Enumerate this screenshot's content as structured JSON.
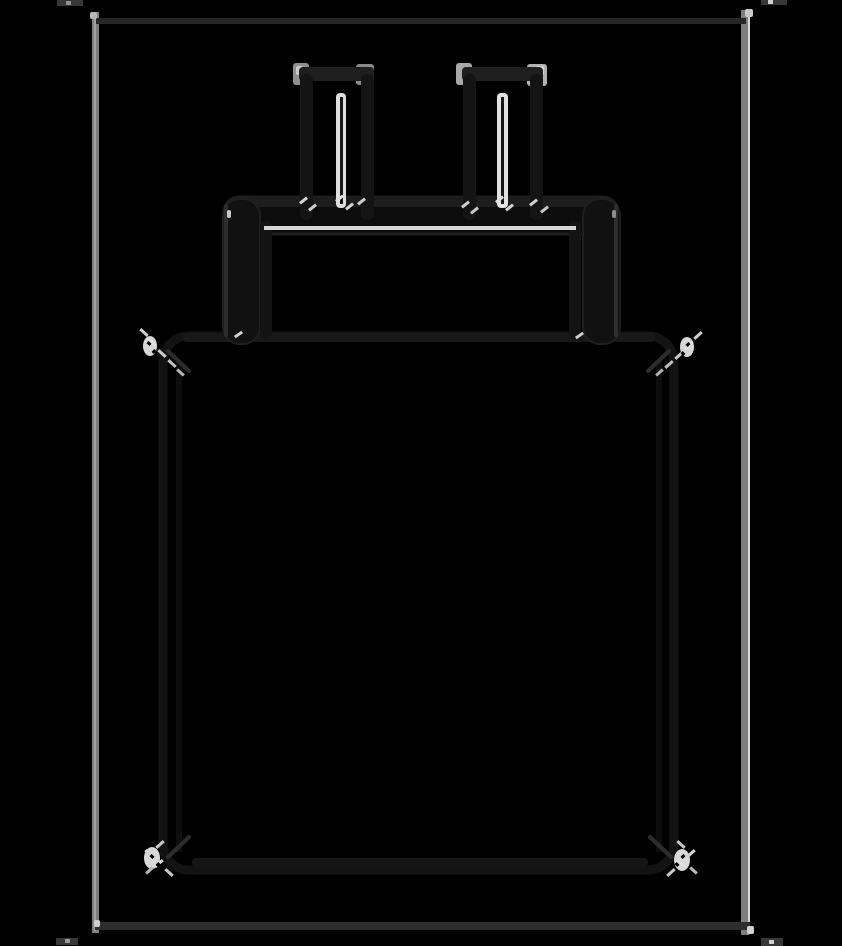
{
  "canvas": {
    "width": 842,
    "height": 946,
    "background": "#000000"
  },
  "figure": {
    "subject": "wall-charger-plug-sketch",
    "style": "inverted pencil sketch: gray and white strokes on black"
  },
  "palette": {
    "background": "#000000",
    "frame_side_gray": "#7e7e7e",
    "frame_horizontal_dark": "#2a2a2a",
    "stroke_dark": "#141414",
    "stroke_medium": "#1f1f1f",
    "highlight_white": "#dedede",
    "corner_gray": "#8f8f8f"
  },
  "drawing": {
    "shapes": [
      {
        "n": "frame-left-edge",
        "t": "rect",
        "x": 92,
        "y": 12,
        "w": 7,
        "h": 921,
        "f": "#7e7e7e"
      },
      {
        "n": "frame-left-core",
        "t": "rect",
        "x": 94,
        "y": 14,
        "w": 2,
        "h": 917,
        "f": "#a2a2a2"
      },
      {
        "n": "frame-right-edge",
        "t": "rect",
        "x": 741,
        "y": 10,
        "w": 8,
        "h": 925,
        "f": "#7e7e7e"
      },
      {
        "n": "frame-right-core",
        "t": "rect",
        "x": 748,
        "y": 12,
        "w": 2,
        "h": 921,
        "f": "#d8d8d8"
      },
      {
        "n": "frame-top-edge",
        "t": "rect",
        "x": 96,
        "y": 18,
        "w": 650,
        "h": 6,
        "f": "#272727"
      },
      {
        "n": "frame-bottom-edge",
        "t": "rect",
        "x": 95,
        "y": 922,
        "w": 655,
        "h": 8,
        "f": "#2d2d2d"
      },
      {
        "n": "frame-corner-dot-tl",
        "t": "rect",
        "x": 90,
        "y": 12,
        "w": 7,
        "h": 7,
        "rx": 2,
        "f": "#b8b8b8"
      },
      {
        "n": "frame-corner-dot-tr",
        "t": "rect",
        "x": 745,
        "y": 9,
        "w": 8,
        "h": 8,
        "rx": 2,
        "f": "#c9c9c9"
      },
      {
        "n": "frame-corner-dot-bl",
        "t": "rect",
        "x": 94,
        "y": 920,
        "w": 6,
        "h": 7,
        "rx": 2,
        "f": "#cfcfcf"
      },
      {
        "n": "frame-corner-dot-br",
        "t": "rect",
        "x": 747,
        "y": 926,
        "w": 7,
        "h": 8,
        "rx": 2,
        "f": "#d2d2d2"
      },
      {
        "n": "frame-tick-top-left",
        "t": "rect",
        "x": 57,
        "y": 0,
        "w": 26,
        "h": 6,
        "f": "#383838"
      },
      {
        "n": "frame-tick-top-left-dot",
        "t": "rect",
        "x": 66,
        "y": 1,
        "w": 5,
        "h": 4,
        "f": "#8e8e8e"
      },
      {
        "n": "frame-tick-top-right",
        "t": "rect",
        "x": 761,
        "y": 0,
        "w": 26,
        "h": 5,
        "f": "#383838"
      },
      {
        "n": "frame-tick-top-right-dot",
        "t": "rect",
        "x": 768,
        "y": 0,
        "w": 5,
        "h": 4,
        "f": "#cfcfcf"
      },
      {
        "n": "frame-tick-bottom-left",
        "t": "rect",
        "x": 56,
        "y": 938,
        "w": 22,
        "h": 7,
        "f": "#383838"
      },
      {
        "n": "frame-tick-bottom-left-dot",
        "t": "rect",
        "x": 65,
        "y": 939,
        "w": 5,
        "h": 4,
        "f": "#9a9a9a"
      },
      {
        "n": "frame-tick-bottom-right",
        "t": "rect",
        "x": 761,
        "y": 938,
        "w": 22,
        "h": 8,
        "f": "#383838"
      },
      {
        "n": "frame-tick-bottom-right-dot",
        "t": "rect",
        "x": 769,
        "y": 940,
        "w": 5,
        "h": 4,
        "f": "#cfcfcf"
      },
      {
        "n": "body-outline",
        "t": "rect",
        "x": 163,
        "y": 336,
        "w": 511,
        "h": 534,
        "rx": 26,
        "f": "none",
        "s": "#131313",
        "sw": 9
      },
      {
        "n": "body-left-inner-line",
        "t": "rect",
        "x": 176,
        "y": 360,
        "w": 6,
        "h": 492,
        "f": "#0e0e0e"
      },
      {
        "n": "body-right-inner-line",
        "t": "rect",
        "x": 656,
        "y": 360,
        "w": 6,
        "h": 492,
        "f": "#0e0e0e"
      },
      {
        "n": "body-top-edge-emphasis",
        "t": "rect",
        "x": 183,
        "y": 333,
        "w": 472,
        "h": 9,
        "rx": 4,
        "f": "#181818"
      },
      {
        "n": "body-bottom-edge-emphasis",
        "t": "rect",
        "x": 192,
        "y": 858,
        "w": 456,
        "h": 9,
        "rx": 4,
        "f": "#151515"
      },
      {
        "n": "body-corner-diagonal-tl",
        "t": "line",
        "x1": 168,
        "y1": 351,
        "x2": 189,
        "y2": 371,
        "s": "#2c2c2c",
        "sw": 4
      },
      {
        "n": "body-corner-diagonal-tr",
        "t": "line",
        "x1": 669,
        "y1": 351,
        "x2": 648,
        "y2": 371,
        "s": "#2c2c2c",
        "sw": 4
      },
      {
        "n": "body-corner-diagonal-bl",
        "t": "line",
        "x1": 189,
        "y1": 837,
        "x2": 168,
        "y2": 857,
        "s": "#2c2c2c",
        "sw": 4
      },
      {
        "n": "body-corner-diagonal-br",
        "t": "line",
        "x1": 650,
        "y1": 837,
        "x2": 671,
        "y2": 857,
        "s": "#2c2c2c",
        "sw": 4
      },
      {
        "n": "collar-bar",
        "t": "rect",
        "x": 224,
        "y": 197,
        "w": 394,
        "h": 37,
        "rx": 15,
        "f": "#0c0c0c",
        "s": "#1e1e1e",
        "sw": 3
      },
      {
        "n": "collar-top-emphasis",
        "t": "rect",
        "x": 240,
        "y": 197,
        "w": 362,
        "h": 10,
        "rx": 4,
        "f": "#1d1d1d"
      },
      {
        "n": "collar-left-leg",
        "t": "rect",
        "x": 223,
        "y": 199,
        "w": 37,
        "h": 145,
        "rx": 17,
        "f": "#111111",
        "s": "#1f1f1f",
        "sw": 2
      },
      {
        "n": "collar-left-leg-outer-edge",
        "t": "rect",
        "x": 224,
        "y": 204,
        "w": 4,
        "h": 133,
        "rx": 2,
        "f": "#2e2e2e"
      },
      {
        "n": "collar-left-leg-inner-line",
        "t": "rect",
        "x": 260,
        "y": 221,
        "w": 12,
        "h": 117,
        "rx": 5,
        "f": "#131313"
      },
      {
        "n": "collar-right-leg",
        "t": "rect",
        "x": 583,
        "y": 199,
        "w": 37,
        "h": 145,
        "rx": 17,
        "f": "#111111",
        "s": "#1f1f1f",
        "sw": 2
      },
      {
        "n": "collar-right-leg-outer-edge",
        "t": "rect",
        "x": 614,
        "y": 204,
        "w": 4,
        "h": 133,
        "rx": 2,
        "f": "#2e2e2e"
      },
      {
        "n": "collar-right-leg-inner-line",
        "t": "rect",
        "x": 569,
        "y": 221,
        "w": 12,
        "h": 117,
        "rx": 5,
        "f": "#131313"
      },
      {
        "n": "left-prong-top-corner-left-highlight",
        "t": "rect",
        "x": 293,
        "y": 63,
        "w": 16,
        "h": 22,
        "rx": 3,
        "f": "#8f8f8f"
      },
      {
        "n": "left-prong-top-corner-left-bright",
        "t": "rect",
        "x": 296,
        "y": 66,
        "w": 7,
        "h": 9,
        "rx": 2,
        "f": "#c9c9c9"
      },
      {
        "n": "left-prong-top-corner-right-highlight",
        "t": "rect",
        "x": 356,
        "y": 64,
        "w": 18,
        "h": 21,
        "rx": 3,
        "f": "#8a8a8a"
      },
      {
        "n": "left-prong-top-cap",
        "t": "rect",
        "x": 299,
        "y": 67,
        "w": 75,
        "h": 14,
        "rx": 4,
        "f": "#1f1f1f"
      },
      {
        "n": "left-prong-left-edge",
        "t": "rect",
        "x": 300,
        "y": 74,
        "w": 13,
        "h": 146,
        "rx": 6,
        "f": "#141414"
      },
      {
        "n": "left-prong-right-edge",
        "t": "rect",
        "x": 361,
        "y": 74,
        "w": 13,
        "h": 146,
        "rx": 6,
        "f": "#141414"
      },
      {
        "n": "left-prong-inner-highlight",
        "t": "rect",
        "x": 336,
        "y": 93,
        "w": 10,
        "h": 115,
        "rx": 4,
        "f": "#dedede"
      },
      {
        "n": "left-prong-inner-core",
        "t": "rect",
        "x": 340,
        "y": 97,
        "w": 3,
        "h": 107,
        "f": "#161616"
      },
      {
        "n": "right-prong-top-corner-left-highlight",
        "t": "rect",
        "x": 456,
        "y": 63,
        "w": 16,
        "h": 22,
        "rx": 3,
        "f": "#a8a8a8"
      },
      {
        "n": "right-prong-top-corner-right-highlight",
        "t": "rect",
        "x": 527,
        "y": 64,
        "w": 20,
        "h": 22,
        "rx": 3,
        "f": "#b2b2b2"
      },
      {
        "n": "right-prong-top-corner-right-bright",
        "t": "rect",
        "x": 536,
        "y": 66,
        "w": 8,
        "h": 9,
        "rx": 2,
        "f": "#d6d6d6"
      },
      {
        "n": "right-prong-top-cap",
        "t": "rect",
        "x": 462,
        "y": 67,
        "w": 81,
        "h": 14,
        "rx": 4,
        "f": "#1f1f1f"
      },
      {
        "n": "right-prong-left-edge",
        "t": "rect",
        "x": 463,
        "y": 74,
        "w": 13,
        "h": 146,
        "rx": 6,
        "f": "#141414"
      },
      {
        "n": "right-prong-right-edge",
        "t": "rect",
        "x": 530,
        "y": 74,
        "w": 13,
        "h": 146,
        "rx": 6,
        "f": "#141414"
      },
      {
        "n": "right-prong-inner-highlight",
        "t": "rect",
        "x": 497,
        "y": 93,
        "w": 11,
        "h": 115,
        "rx": 4,
        "f": "#e2e2e2"
      },
      {
        "n": "right-prong-inner-core",
        "t": "rect",
        "x": 501,
        "y": 97,
        "w": 3,
        "h": 107,
        "f": "#161616"
      },
      {
        "n": "collar-underline-highlight",
        "t": "rect",
        "x": 264,
        "y": 226,
        "w": 312,
        "h": 4,
        "f": "#d6d6d6"
      },
      {
        "n": "collar-left-leg-top-dot",
        "t": "rect",
        "x": 227,
        "y": 210,
        "w": 4,
        "h": 8,
        "rx": 2,
        "f": "#c9c9c9"
      },
      {
        "n": "collar-left-leg-bottom-tick",
        "t": "rect",
        "x": 234,
        "y": 333,
        "w": 9,
        "h": 3,
        "rot": -35,
        "f": "#d2d2d2"
      },
      {
        "n": "collar-right-leg-top-dot",
        "t": "rect",
        "x": 612,
        "y": 210,
        "w": 4,
        "h": 8,
        "rx": 2,
        "f": "#8e8e8e"
      },
      {
        "n": "collar-right-leg-bottom-tick",
        "t": "rect",
        "x": 575,
        "y": 334,
        "w": 9,
        "h": 3,
        "rot": -35,
        "f": "#cfcfcf"
      },
      {
        "n": "left-prong-base-tick-1",
        "t": "rect",
        "x": 299,
        "y": 199,
        "w": 9,
        "h": 3,
        "rot": -38,
        "f": "#d6d6d6"
      },
      {
        "n": "left-prong-base-tick-2",
        "t": "rect",
        "x": 308,
        "y": 206,
        "w": 9,
        "h": 3,
        "rot": -38,
        "f": "#cfcfcf"
      },
      {
        "n": "left-prong-base-tick-3",
        "t": "rect",
        "x": 335,
        "y": 197,
        "w": 9,
        "h": 3,
        "rot": -38,
        "f": "#e0e0e0"
      },
      {
        "n": "left-prong-base-tick-4",
        "t": "rect",
        "x": 345,
        "y": 205,
        "w": 9,
        "h": 3,
        "rot": -38,
        "f": "#d6d6d6"
      },
      {
        "n": "left-prong-base-tick-5",
        "t": "rect",
        "x": 357,
        "y": 200,
        "w": 9,
        "h": 3,
        "rot": -38,
        "f": "#cccccc"
      },
      {
        "n": "right-prong-base-tick-1",
        "t": "rect",
        "x": 461,
        "y": 203,
        "w": 9,
        "h": 3,
        "rot": -38,
        "f": "#cfcfcf"
      },
      {
        "n": "right-prong-base-tick-2",
        "t": "rect",
        "x": 470,
        "y": 209,
        "w": 9,
        "h": 3,
        "rot": -38,
        "f": "#c6c6c6"
      },
      {
        "n": "right-prong-base-tick-3",
        "t": "rect",
        "x": 495,
        "y": 198,
        "w": 9,
        "h": 3,
        "rot": -38,
        "f": "#e0e0e0"
      },
      {
        "n": "right-prong-base-tick-4",
        "t": "rect",
        "x": 505,
        "y": 206,
        "w": 9,
        "h": 3,
        "rot": -38,
        "f": "#d2d2d2"
      },
      {
        "n": "right-prong-base-tick-5",
        "t": "rect",
        "x": 529,
        "y": 201,
        "w": 9,
        "h": 3,
        "rot": -38,
        "f": "#cfcfcf"
      },
      {
        "n": "right-prong-base-tick-6",
        "t": "rect",
        "x": 540,
        "y": 208,
        "w": 9,
        "h": 3,
        "rot": -38,
        "f": "#c6c6c6"
      },
      {
        "n": "body-corner-sketch-tl-blob",
        "t": "ellipse",
        "cx": 150,
        "cy": 346,
        "rx": 7,
        "ry": 10,
        "f": "#d7d7d7"
      },
      {
        "n": "body-corner-sketch-tl-tick-1",
        "t": "rect",
        "x": 139,
        "y": 331,
        "w": 10,
        "h": 3,
        "rot": 42,
        "f": "#cfcfcf"
      },
      {
        "n": "body-corner-sketch-tl-tick-2",
        "t": "rect",
        "x": 147,
        "y": 341,
        "w": 10,
        "h": 3,
        "rot": 42,
        "f": "#e0e0e0"
      },
      {
        "n": "body-corner-sketch-tl-tick-3",
        "t": "rect",
        "x": 157,
        "y": 352,
        "w": 10,
        "h": 3,
        "rot": 42,
        "f": "#cccccc"
      },
      {
        "n": "body-corner-sketch-tl-tick-4",
        "t": "rect",
        "x": 167,
        "y": 362,
        "w": 10,
        "h": 3,
        "rot": 42,
        "f": "#c2c2c2"
      },
      {
        "n": "body-corner-sketch-tl-tick-5",
        "t": "rect",
        "x": 176,
        "y": 371,
        "w": 9,
        "h": 3,
        "rot": 42,
        "f": "#b5b5b5"
      },
      {
        "n": "body-corner-sketch-tl-speck-1",
        "t": "rect",
        "x": 147,
        "y": 342,
        "w": 4,
        "h": 3,
        "rot": 42,
        "f": "#000000"
      },
      {
        "n": "body-corner-sketch-tl-speck-2",
        "t": "rect",
        "x": 152,
        "y": 350,
        "w": 4,
        "h": 3,
        "rot": -45,
        "f": "#000000"
      },
      {
        "n": "body-corner-sketch-tr-blob",
        "t": "ellipse",
        "cx": 687,
        "cy": 347,
        "rx": 7,
        "ry": 10,
        "f": "#d7d7d7"
      },
      {
        "n": "body-corner-sketch-tr-tick-1",
        "t": "rect",
        "x": 693,
        "y": 334,
        "w": 10,
        "h": 3,
        "rot": -42,
        "f": "#cfcfcf"
      },
      {
        "n": "body-corner-sketch-tr-tick-2",
        "t": "rect",
        "x": 684,
        "y": 344,
        "w": 10,
        "h": 3,
        "rot": -42,
        "f": "#e0e0e0"
      },
      {
        "n": "body-corner-sketch-tr-tick-3",
        "t": "rect",
        "x": 674,
        "y": 354,
        "w": 10,
        "h": 3,
        "rot": -42,
        "f": "#c9c9c9"
      },
      {
        "n": "body-corner-sketch-tr-tick-4",
        "t": "rect",
        "x": 664,
        "y": 363,
        "w": 10,
        "h": 3,
        "rot": -42,
        "f": "#bdbdbd"
      },
      {
        "n": "body-corner-sketch-tr-tick-5",
        "t": "rect",
        "x": 655,
        "y": 371,
        "w": 9,
        "h": 3,
        "rot": -42,
        "f": "#b0b0b0"
      },
      {
        "n": "body-corner-sketch-tr-speck-1",
        "t": "rect",
        "x": 686,
        "y": 343,
        "w": 4,
        "h": 3,
        "rot": -42,
        "f": "#000000"
      },
      {
        "n": "body-corner-sketch-tr-speck-2",
        "t": "rect",
        "x": 681,
        "y": 352,
        "w": 4,
        "h": 3,
        "rot": 45,
        "f": "#000000"
      },
      {
        "n": "body-corner-sketch-bl-blob",
        "t": "ellipse",
        "cx": 152,
        "cy": 858,
        "rx": 8,
        "ry": 11,
        "f": "#d9d9d9"
      },
      {
        "n": "body-corner-sketch-bl-tick-1",
        "t": "rect",
        "x": 155,
        "y": 843,
        "w": 10,
        "h": 3,
        "rot": -42,
        "f": "#c6c6c6"
      },
      {
        "n": "body-corner-sketch-bl-tick-2",
        "t": "rect",
        "x": 144,
        "y": 852,
        "w": 10,
        "h": 3,
        "rot": 42,
        "f": "#d2d2d2"
      },
      {
        "n": "body-corner-sketch-bl-tick-3",
        "t": "rect",
        "x": 154,
        "y": 862,
        "w": 10,
        "h": 3,
        "rot": -42,
        "f": "#e0e0e0"
      },
      {
        "n": "body-corner-sketch-bl-tick-4",
        "t": "rect",
        "x": 164,
        "y": 871,
        "w": 10,
        "h": 3,
        "rot": 42,
        "f": "#c9c9c9"
      },
      {
        "n": "body-corner-sketch-bl-tick-5",
        "t": "rect",
        "x": 145,
        "y": 869,
        "w": 9,
        "h": 3,
        "rot": -42,
        "f": "#b8b8b8"
      },
      {
        "n": "body-corner-sketch-bl-speck-1",
        "t": "rect",
        "x": 150,
        "y": 855,
        "w": 4,
        "h": 3,
        "rot": 42,
        "f": "#000000"
      },
      {
        "n": "body-corner-sketch-bl-speck-2",
        "t": "rect",
        "x": 156,
        "y": 863,
        "w": 4,
        "h": 3,
        "rot": -45,
        "f": "#000000"
      },
      {
        "n": "body-corner-sketch-br-blob",
        "t": "ellipse",
        "cx": 682,
        "cy": 860,
        "rx": 8,
        "ry": 11,
        "f": "#d9d9d9"
      },
      {
        "n": "body-corner-sketch-br-tick-1",
        "t": "rect",
        "x": 676,
        "y": 843,
        "w": 10,
        "h": 3,
        "rot": 42,
        "f": "#c6c6c6"
      },
      {
        "n": "body-corner-sketch-br-tick-2",
        "t": "rect",
        "x": 686,
        "y": 852,
        "w": 10,
        "h": 3,
        "rot": -42,
        "f": "#d2d2d2"
      },
      {
        "n": "body-corner-sketch-br-tick-3",
        "t": "rect",
        "x": 676,
        "y": 862,
        "w": 10,
        "h": 3,
        "rot": 42,
        "f": "#e0e0e0"
      },
      {
        "n": "body-corner-sketch-br-tick-4",
        "t": "rect",
        "x": 666,
        "y": 871,
        "w": 10,
        "h": 3,
        "rot": -42,
        "f": "#c9c9c9"
      },
      {
        "n": "body-corner-sketch-br-tick-5",
        "t": "rect",
        "x": 689,
        "y": 869,
        "w": 9,
        "h": 3,
        "rot": 42,
        "f": "#b8b8b8"
      },
      {
        "n": "body-corner-sketch-br-speck-1",
        "t": "rect",
        "x": 681,
        "y": 855,
        "w": 4,
        "h": 3,
        "rot": -42,
        "f": "#000000"
      },
      {
        "n": "body-corner-sketch-br-speck-2",
        "t": "rect",
        "x": 675,
        "y": 863,
        "w": 4,
        "h": 3,
        "rot": 45,
        "f": "#000000"
      }
    ]
  }
}
